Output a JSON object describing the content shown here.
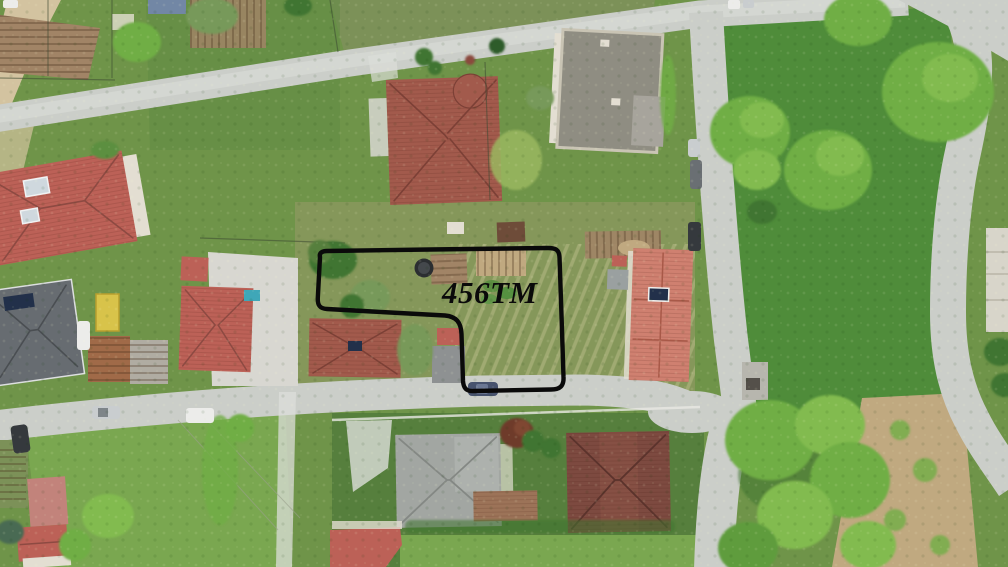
{
  "annotation": {
    "label": "456TM"
  },
  "palette": {
    "grass": "#6f9449",
    "grass_dark": "#5d8a42",
    "field_green": "#4f8c3a",
    "meadow": "#7aa750",
    "parcel_grass": "#85975a",
    "scrub": "#7c9158",
    "lawn_dark": "#567f3d",
    "road": "#cbcec9",
    "road_pale": "#dcded9",
    "dirt": "#d3c3a0",
    "soil": "#a18466",
    "soil_light": "#c0a980",
    "rubble": "#d8d7d1",
    "wall_white": "#e3ded2",
    "roof_red": "#bc6157",
    "roof_terracotta": "#a25a4c",
    "roof_salmon": "#cf8070",
    "roof_brown": "#7d4a40",
    "roof_gray_light": "#a2a6a2",
    "roof_gray_dark": "#676c71",
    "roof_flat": "#8f8d82",
    "tree_bright": "#82bb4f",
    "tree_mid": "#6fae45",
    "tree_dark": "#3f7431",
    "tree_olive": "#77995a",
    "rust": "#a06a48",
    "shed_yellow": "#d8c34a",
    "tarp_blue": "#7287a5",
    "solar_dark": "#22304a",
    "solar_teal": "#3fa7b8",
    "plum": "#6e3a2a",
    "car_silver": "#c9cdcf",
    "car_white": "#ececea",
    "car_dark": "#35393d",
    "car_blue": "#47536e",
    "boundary_black": "#0a0a0a"
  }
}
